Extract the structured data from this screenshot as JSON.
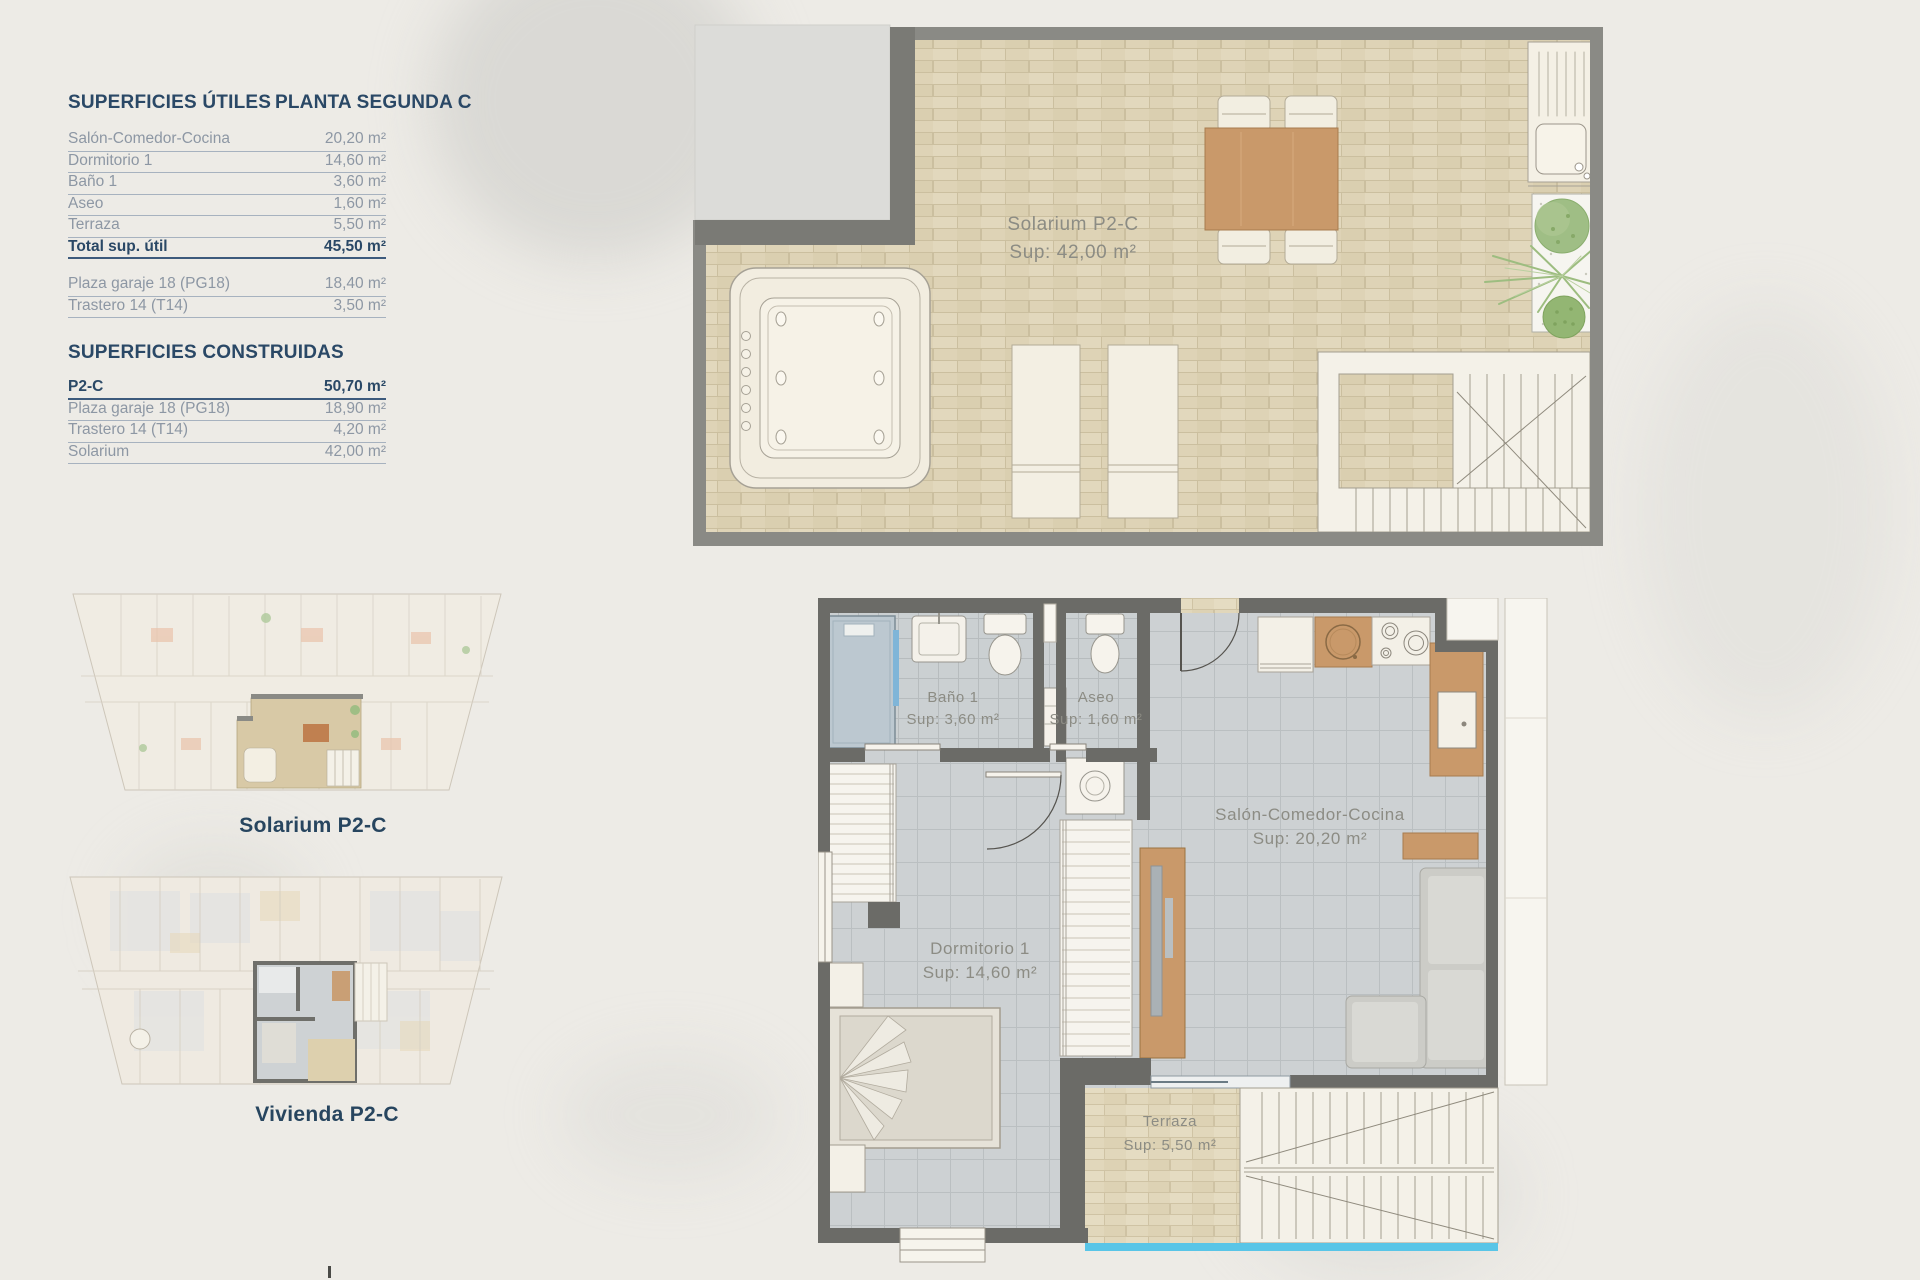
{
  "panel": {
    "utiles": {
      "title": "SUPERFICIES ÚTILES",
      "subtitle": "PLANTA SEGUNDA C",
      "rows": [
        {
          "label": "Salón-Comedor-Cocina",
          "value": "20,20 m²"
        },
        {
          "label": "Dormitorio 1",
          "value": "14,60 m²"
        },
        {
          "label": "Baño 1",
          "value": "3,60 m²"
        },
        {
          "label": "Aseo",
          "value": "1,60 m²"
        },
        {
          "label": "Terraza",
          "value": "5,50 m²"
        }
      ],
      "total": {
        "label": "Total sup. útil",
        "value": "45,50 m²"
      },
      "extra_rows": [
        {
          "label": "Plaza garaje 18 (PG18)",
          "value": "18,40 m²"
        },
        {
          "label": "Trastero 14 (T14)",
          "value": "3,50 m²"
        }
      ]
    },
    "construidas": {
      "title": "SUPERFICIES CONSTRUIDAS",
      "rows": [
        {
          "label": "P2-C",
          "value": "50,70 m²"
        },
        {
          "label": "Plaza garaje 18 (PG18)",
          "value": "18,90 m²"
        },
        {
          "label": "Trastero 14 (T14)",
          "value": "4,20 m²"
        },
        {
          "label": "Solarium",
          "value": "42,00 m²"
        }
      ]
    }
  },
  "thumbnails": {
    "solarium_caption": "Solarium P2-C",
    "vivienda_caption": "Vivienda P2-C"
  },
  "solarium_plan": {
    "label": "Solarium P2-C",
    "sup": "Sup: 42,00 m²"
  },
  "vivienda_plan": {
    "bano": {
      "label": "Baño 1",
      "sup": "Sup: 3,60 m²"
    },
    "aseo": {
      "label": "Aseo",
      "sup": "Sup: 1,60 m²"
    },
    "salon": {
      "label": "Salón-Comedor-Cocina",
      "sup": "Sup: 20,20 m²"
    },
    "dormitorio": {
      "label": "Dormitorio 1",
      "sup": "Sup: 14,60 m²"
    },
    "terraza": {
      "label": "Terraza",
      "sup": "Sup: 5,50 m²"
    }
  },
  "colors": {
    "accent_navy": "#2a4866",
    "row_text": "#8d97a4",
    "wall_dark": "#6b6b67",
    "wall_medium": "#8a8a85",
    "floor_beige": "#ded3b6",
    "floor_gray": "#cdd1d3",
    "terrace_beige": "#e1d7bb",
    "wood": "#c9996a",
    "glass_blue": "#59c5e7",
    "plan_label_gray": "#8c8c84"
  }
}
